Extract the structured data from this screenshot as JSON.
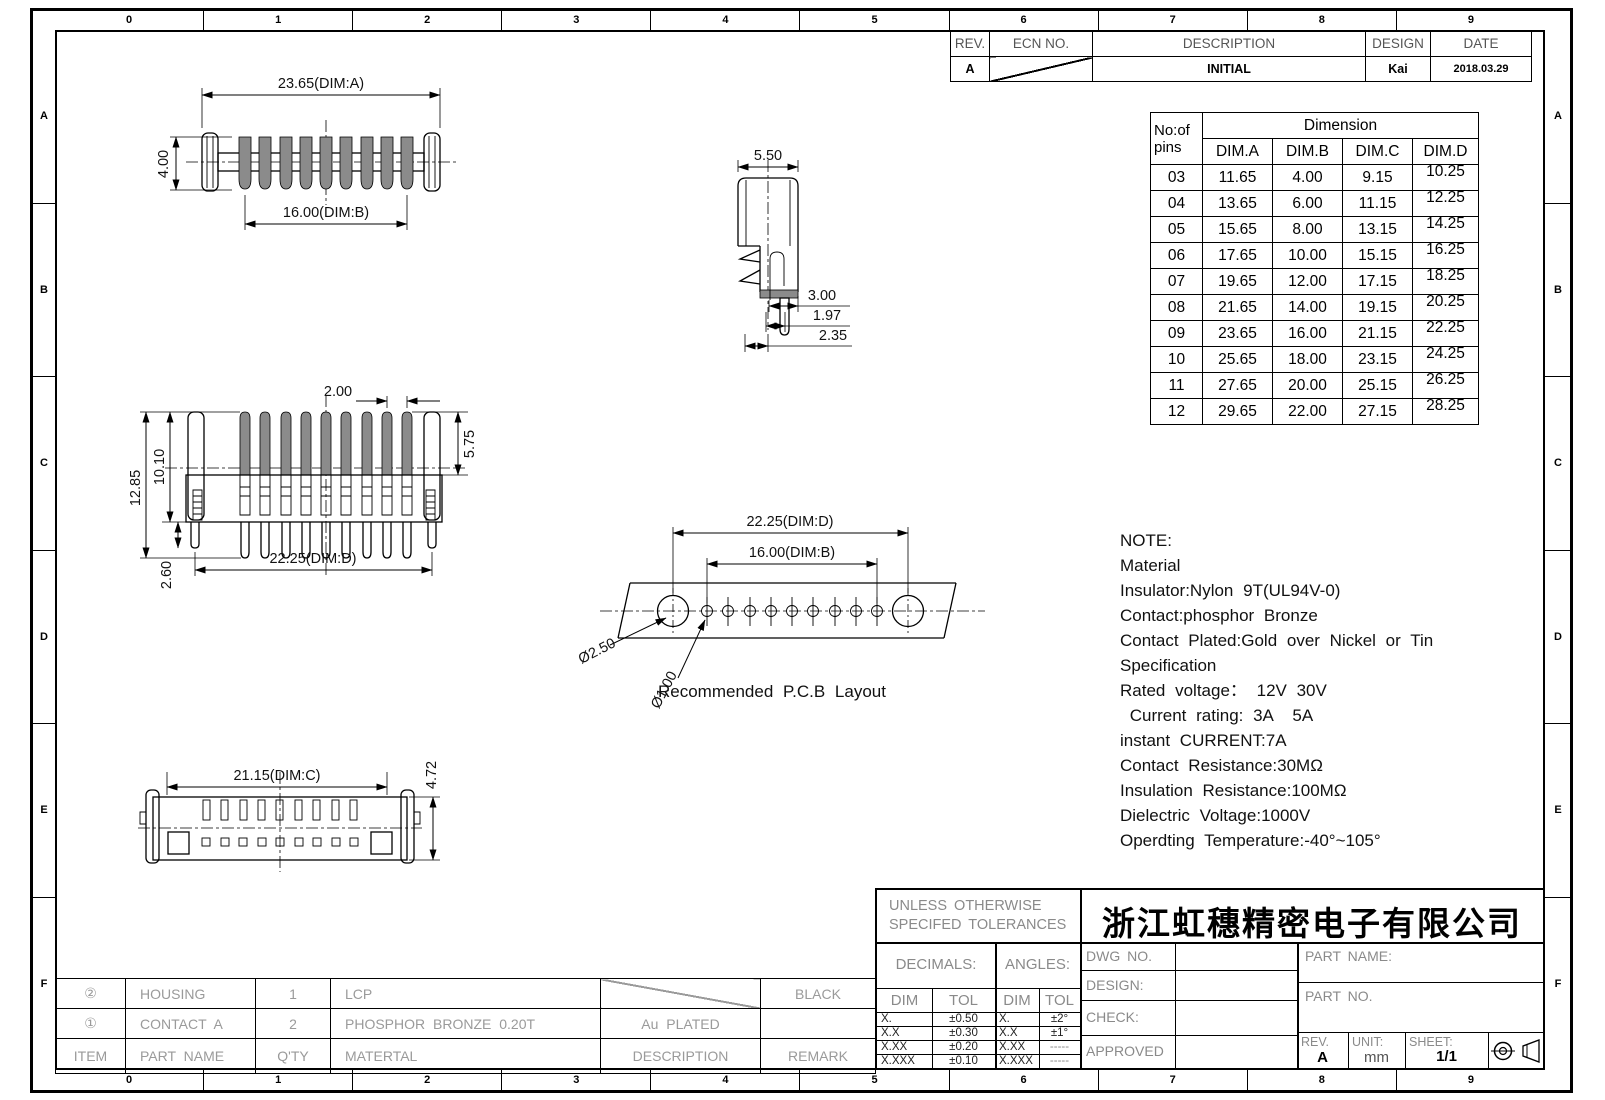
{
  "border": {
    "top_zones": [
      "0",
      "1",
      "2",
      "3",
      "4",
      "5",
      "6",
      "7",
      "8",
      "9"
    ],
    "bottom_zones": [
      "0",
      "1",
      "2",
      "3",
      "4",
      "5",
      "6",
      "7",
      "8",
      "9"
    ],
    "left_zones": [
      "A",
      "B",
      "C",
      "D",
      "E",
      "F"
    ],
    "right_zones": [
      "A",
      "B",
      "C",
      "D",
      "E",
      "F"
    ]
  },
  "colors": {
    "line": "#000000",
    "pin_fill": "#8b8b8b",
    "label_gray": "#8a8a8a"
  },
  "revision_table": {
    "headers": [
      "REV.",
      "ECN NO.",
      "DESCRIPTION",
      "DESIGN",
      "DATE"
    ],
    "rows": [
      {
        "rev": "A",
        "ecn_no": "",
        "description": "INITIAL",
        "design": "Kai",
        "date": "2018.03.29"
      }
    ]
  },
  "dimension_table": {
    "pins_header": [
      "No:of",
      "pins"
    ],
    "group_header": "Dimension",
    "dim_headers": [
      "DIM.A",
      "DIM.B",
      "DIM.C",
      "DIM.D"
    ],
    "rows": [
      [
        "03",
        "11.65",
        "4.00",
        "9.15",
        "10.25"
      ],
      [
        "04",
        "13.65",
        "6.00",
        "11.15",
        "12.25"
      ],
      [
        "05",
        "15.65",
        "8.00",
        "13.15",
        "14.25"
      ],
      [
        "06",
        "17.65",
        "10.00",
        "15.15",
        "16.25"
      ],
      [
        "07",
        "19.65",
        "12.00",
        "17.15",
        "18.25"
      ],
      [
        "08",
        "21.65",
        "14.00",
        "19.15",
        "20.25"
      ],
      [
        "09",
        "23.65",
        "16.00",
        "21.15",
        "22.25"
      ],
      [
        "10",
        "25.65",
        "18.00",
        "23.15",
        "24.25"
      ],
      [
        "11",
        "27.65",
        "20.00",
        "25.15",
        "26.25"
      ],
      [
        "12",
        "29.65",
        "22.00",
        "27.15",
        "28.25"
      ]
    ]
  },
  "views": {
    "top_view": {
      "dim_a": "23.65(DIM:A)",
      "dim_h": "4.00",
      "dim_b": "16.00(DIM:B)"
    },
    "side_view": {
      "dim_w": "5.50",
      "dim_1": "3.00",
      "dim_2": "1.97",
      "dim_3": "2.35"
    },
    "front_view": {
      "dim_pitch": "2.00",
      "dim_total_h": "12.85",
      "dim_h": "10.10",
      "dim_pin": "5.75",
      "dim_tail": "2.60",
      "dim_d": "22.25(DIM:D)"
    },
    "pcb_layout": {
      "dim_d": "22.25(DIM:D)",
      "dim_b": "16.00(DIM:B)",
      "hole_big": "Ø2.50",
      "hole_small": "Ø1.00",
      "caption": "Recommended P.C.B Layout"
    },
    "bottom_view": {
      "dim_c": "21.15(DIM:C)",
      "dim_h": "4.72"
    }
  },
  "note": {
    "lines": [
      "NOTE:",
      "Material",
      "Insulator:Nylon 9T(UL94V-0)",
      "Contact:phosphor Bronze",
      "Contact Plated:Gold over Nickel or Tin",
      "Specification",
      "Rated voltage： 12V 30V",
      " Current rating: 3A  5A",
      "instant CURRENT:7A",
      "Contact Resistance:30MΩ",
      "Insulation Resistance:100MΩ",
      "Dielectric Voltage:1000V",
      "Operdting Temperature:-40°~105°"
    ]
  },
  "parts_table": {
    "headers": [
      "ITEM",
      "PART NAME",
      "Q'TY",
      "MATERTAL",
      "DESCRIPTION",
      "REMARK"
    ],
    "rows": [
      [
        "②",
        "HOUSING",
        "1",
        "LCP",
        "",
        "BLACK"
      ],
      [
        "①",
        "CONTACT A",
        "2",
        "PHOSPHOR BRONZE 0.20T",
        "Au PLATED",
        ""
      ]
    ]
  },
  "title_block": {
    "tolerance_note": [
      "UNLESS OTHERWISE",
      "SPECIFED TOLERANCES"
    ],
    "company": "浙江虹穗精密电子有限公司",
    "decimals_label": "DECIMALS:",
    "angles_label": "ANGLES:",
    "dim_header": "DIM",
    "tol_header": "TOL",
    "decimals_rows": [
      [
        "X.",
        "±0.50"
      ],
      [
        "X.X",
        "±0.30"
      ],
      [
        "X.XX",
        "±0.20"
      ],
      [
        "X.XXX",
        "±0.10"
      ]
    ],
    "angles_rows": [
      [
        "X.",
        "±2°"
      ],
      [
        "X.X",
        "±1°"
      ],
      [
        "X.XX",
        "-----"
      ],
      [
        "X.XXX",
        "-----"
      ]
    ],
    "dwg_no_label": "DWG NO.",
    "design_label": "DESIGN:",
    "check_label": "CHECK:",
    "approved_label": "APPROVED",
    "part_name_label": "PART NAME:",
    "part_no_label": "PART NO.",
    "rev_label": "REV.",
    "rev_value": "A",
    "unit_label": "UNIT:",
    "unit_value": "mm",
    "sheet_label": "SHEET:",
    "sheet_value": "1/1"
  }
}
